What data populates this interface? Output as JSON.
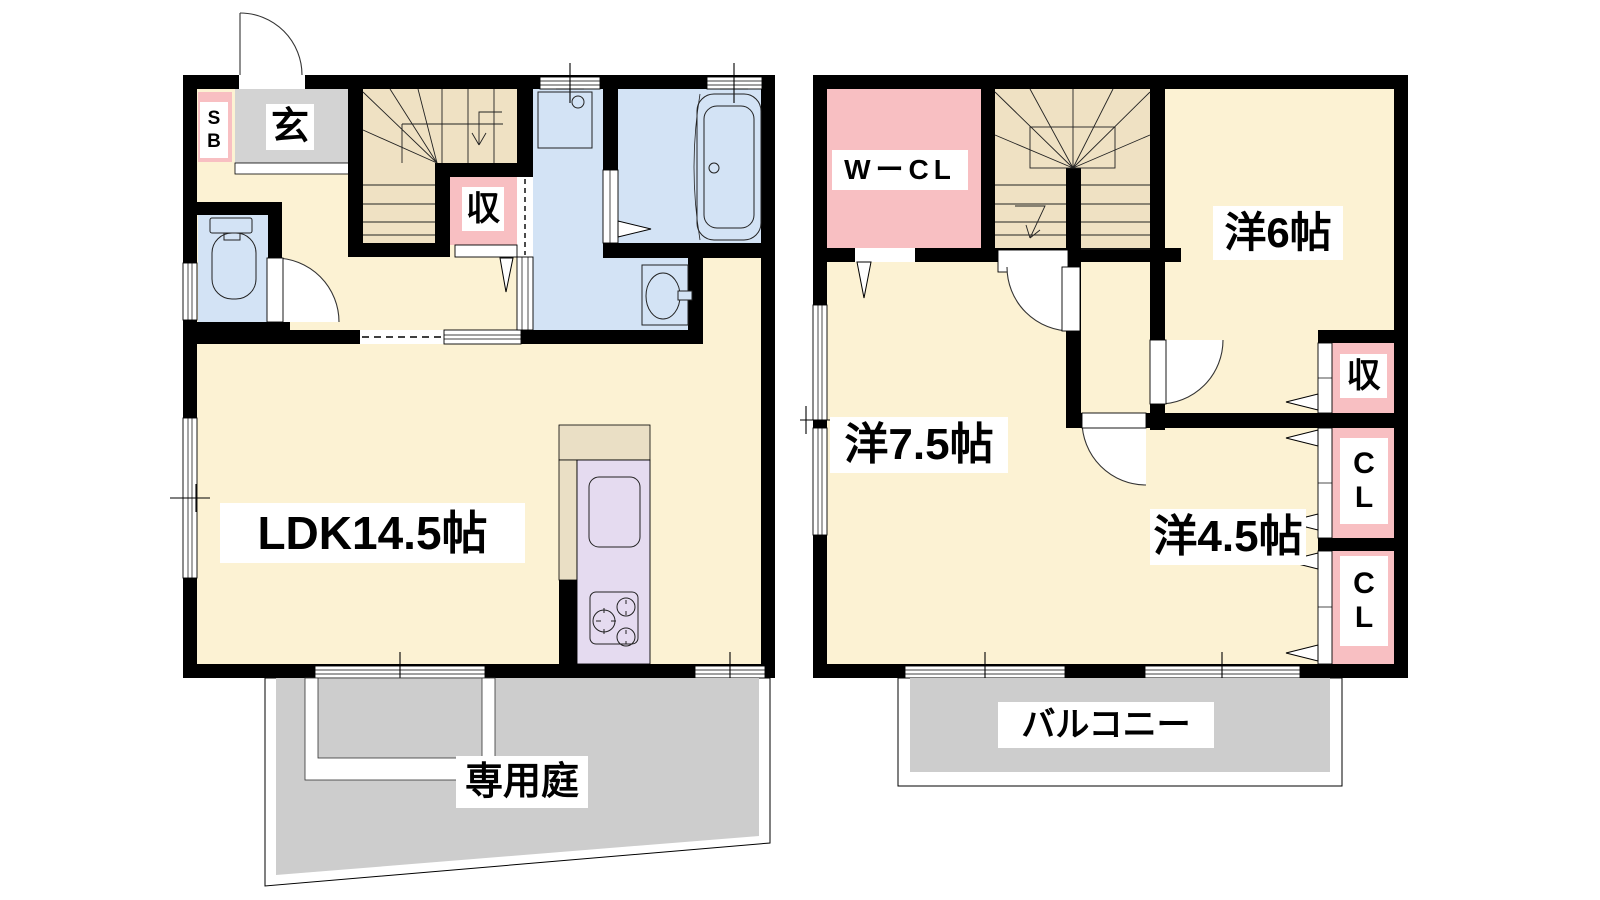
{
  "title": "2-story apartment floor plan",
  "floor1": {
    "entrance_label": "玄",
    "shoe_box_line1": "S",
    "shoe_box_line2": "B",
    "storage_label": "収",
    "ldk_label": "LDK14.5帖",
    "garden_label": "専用庭"
  },
  "floor2": {
    "walk_in_closet_label": "WーCL",
    "room6_label": "洋6帖",
    "room75_label": "洋7.5帖",
    "room45_label": "洋4.5帖",
    "storage_label": "収",
    "closet1_line1": "C",
    "closet1_line2": "L",
    "closet2_line1": "C",
    "closet2_line2": "L",
    "balcony_label": "バルコニー"
  },
  "colors": {
    "wall": "#000000",
    "room_cream": "#fcf2d3",
    "stairs_tan": "#efe1c3",
    "accent_pink": "#f8bfc2",
    "wet_area_blue": "#d3e3f5",
    "kitchen_purple": "#e5dbf0",
    "kitchen_counter": "#eadfc5",
    "entrance_gray": "#d3d3d3",
    "outdoor_gray": "#cdcdcd",
    "label_bg": "#ffffff"
  }
}
